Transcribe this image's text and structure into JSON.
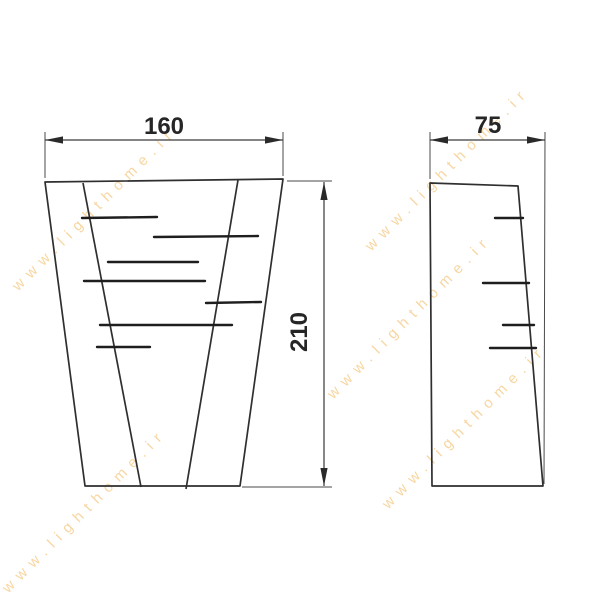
{
  "watermark": {
    "text": "www.lighthome.ir",
    "color": "#f2ba62"
  },
  "dimensions": {
    "front_width": "160",
    "front_height": "210",
    "side_depth": "75"
  },
  "views": {
    "front": {
      "name": "front-view",
      "louver_count": 7
    },
    "side": {
      "name": "side-view",
      "louver_count": 4
    }
  },
  "colors": {
    "line": "#2f2f2f",
    "dimension_text": "#262626",
    "background": "#ffffff"
  }
}
